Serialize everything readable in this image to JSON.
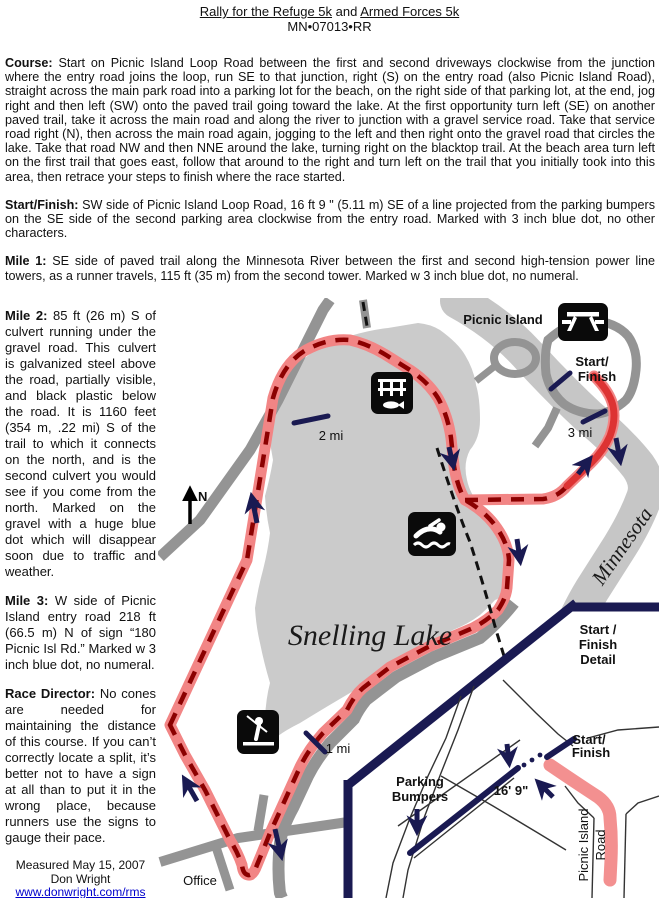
{
  "header": {
    "race1": "Rally for the Refuge 5k",
    "joiner": " and ",
    "race2": "Armed Forces 5k",
    "cert_code": "MN•07013•RR"
  },
  "sections": {
    "course": {
      "label": "Course:",
      "text": "Start on Picnic Island Loop Road between the first and second driveways clockwise from the junction where the entry road joins the loop, run SE to that junction, right (S) on the entry road (also Picnic Island Road), straight across the main park road into a parking lot for the beach, on the right side of that parking lot, at the end, jog right and then left (SW) onto the paved trail going toward the lake.  At the first opportunity turn left (SE) on another paved trail, take it across the main road and along the river to junction with a gravel service road.  Take that service road right (N), then across the main road again, jogging to the left and then right onto the gravel road that circles the lake.  Take that road NW and then NNE around the lake, turning right on the blacktop trail.  At the beach area turn left on the first trail that goes east, follow that around to the right and turn left on the trail that you initially took into this area, then retrace your steps to finish where the race started."
    },
    "start_finish": {
      "label": "Start/Finish:",
      "text": "SW side of Picnic Island Loop Road, 16 ft 9 \" (5.11 m) SE of a line projected from the parking bumpers on the SE side of the second parking area clockwise from the entry road.  Marked with 3 inch blue dot, no other characters."
    },
    "mile1": {
      "label": "Mile 1:",
      "text": "SE side of paved trail along the Minnesota River between the first and second high-tension power line towers, as a runner travels, 115 ft (35 m) from the second tower.  Marked w 3 inch blue dot, no numeral."
    },
    "mile2": {
      "label": "Mile 2:",
      "text": "85 ft (26 m) S of culvert running under the gravel road.  This culvert is galvanized steel above the road, partially visible, and black plastic below the road.  It is 1160 feet (354 m, .22 mi) S of the trail to which it connects on the north, and is the second culvert you would see if you come from the north.  Marked on the gravel with a huge blue dot which will disappear soon due to traffic and weather."
    },
    "mile3": {
      "label": "Mile 3:",
      "text": "W side of Picnic Island entry road 218 ft (66.5 m) N of sign “180 Picnic Isl Rd.”  Marked w 3 inch blue dot, no numeral."
    },
    "race_director": {
      "label": "Race Director:",
      "text": "No cones are needed for maintaining the distance of this course. If you can’t correctly locate a split, it’s better not to have a sign at all than to put it in the wrong place, because runners use the signs to gauge their pace."
    }
  },
  "footer": {
    "measured_date": "Measured May 15, 2007",
    "measurer": "Don Wright",
    "website": "www.donwright.com/rms",
    "phone": "651/770-3728"
  },
  "map": {
    "labels": {
      "picnic_island": "Picnic Island",
      "start_finish_line1": "Start/",
      "start_finish_line2": "Finish",
      "mile3_marker": "3 mi",
      "mile2_marker": "2 mi",
      "mile1_marker": "1 mi",
      "north": "N",
      "lake_name": "Snelling Lake",
      "river_name": "Minnesota",
      "office": "Office",
      "detail_title_line1": "Start /",
      "detail_title_line2": "Finish",
      "detail_title_line3": "Detail",
      "inset_start_finish_line1": "Start/",
      "inset_start_finish_line2": "Finish",
      "parking_line1": "Parking",
      "parking_line2": "Bumpers",
      "distance_note": "16' 9\"",
      "road_name_line1": "Picnic Island",
      "road_name_line2": "Road"
    },
    "icons": [
      "picnic-table-icon",
      "fishing-pier-icon",
      "swimming-icon",
      "fishing-icon"
    ],
    "colors": {
      "course_pink": "#F28585",
      "course_dash_red": "#8B0000",
      "course_solid_red": "#DD3333",
      "navy": "#1A1A52",
      "road_gray": "#949494",
      "lake_gray": "#CBCBCB",
      "river_gray": "#C6C6C6",
      "link_blue": "#0000CC"
    }
  }
}
